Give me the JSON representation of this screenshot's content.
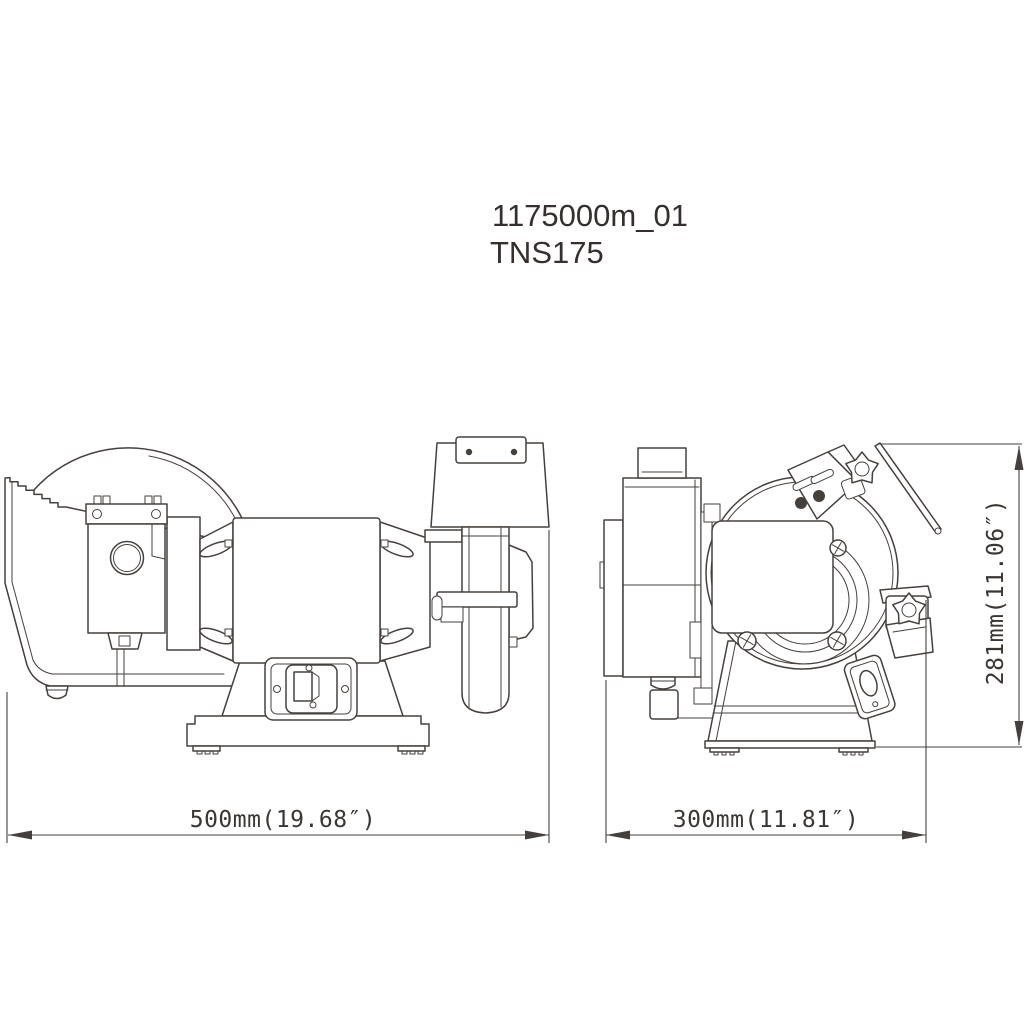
{
  "page": {
    "background_color": "#ffffff",
    "line_color": "#46403d",
    "text_color": "#35302e"
  },
  "header": {
    "drawing_number": "1175000m_01",
    "model_name": "TNS175"
  },
  "drawing": {
    "type": "technical-dimension-drawing",
    "subject": "bench grinder, front and side orthographic views",
    "dimensions": {
      "width": {
        "label": "500mm(19.68″)",
        "mm": 500,
        "inches": 19.68,
        "applies_to": "front view overall width"
      },
      "depth": {
        "label": "300mm(11.81″)",
        "mm": 300,
        "inches": 11.81,
        "applies_to": "side view overall depth"
      },
      "height": {
        "label": "281mm(11.06″)",
        "mm": 281,
        "inches": 11.06,
        "applies_to": "side view overall height"
      }
    }
  }
}
